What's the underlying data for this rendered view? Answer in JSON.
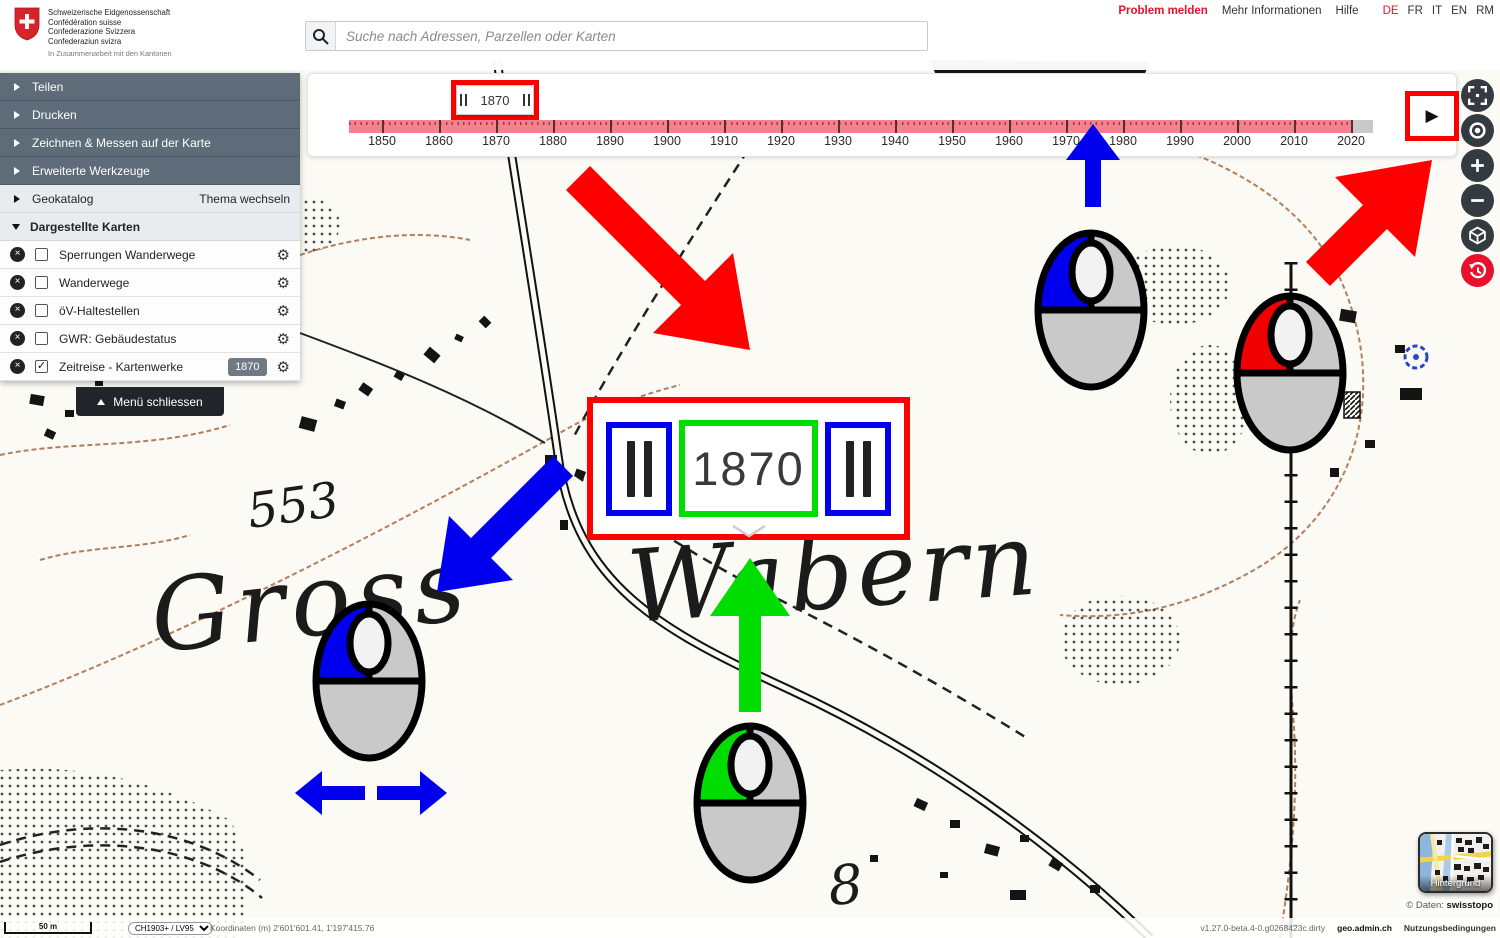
{
  "header": {
    "logo": {
      "lines": [
        "Schweizerische Eidgenossenschaft",
        "Confédération suisse",
        "Confederazione Svizzera",
        "Confederaziun svizra"
      ],
      "subline": "In Zusammenarbeit mit den Kantonen"
    },
    "search": {
      "placeholder": "Suche nach Adressen, Parzellen oder Karten"
    },
    "links": {
      "problem": "Problem melden",
      "more_info": "Mehr Informationen",
      "help": "Hilfe"
    },
    "languages": [
      {
        "label": "DE",
        "active": true
      },
      {
        "label": "FR",
        "active": false
      },
      {
        "label": "IT",
        "active": false
      },
      {
        "label": "EN",
        "active": false
      },
      {
        "label": "RM",
        "active": false
      }
    ]
  },
  "sidebar": {
    "menu_items": [
      {
        "label": "Teilen"
      },
      {
        "label": "Drucken"
      },
      {
        "label": "Zeichnen & Messen auf der Karte"
      },
      {
        "label": "Erweiterte Werkzeuge"
      }
    ],
    "geokatalog": {
      "label": "Geokatalog",
      "action": "Thema wechseln"
    },
    "layers_header": "Dargestellte Karten",
    "layers": [
      {
        "label": "Sperrungen Wanderwege",
        "checked": false
      },
      {
        "label": "Wanderwege",
        "checked": false
      },
      {
        "label": "öV-Haltestellen",
        "checked": false
      },
      {
        "label": "GWR: Gebäudestatus",
        "checked": false
      },
      {
        "label": "Zeitreise - Kartenwerke",
        "checked": true,
        "badge": "1870"
      }
    ],
    "close_menu": "Menü schliessen"
  },
  "timeline": {
    "current_year": "1870",
    "years": [
      "1850",
      "1860",
      "1870",
      "1880",
      "1890",
      "1900",
      "1910",
      "1920",
      "1930",
      "1940",
      "1950",
      "1960",
      "1970",
      "1980",
      "1990",
      "2000",
      "2010",
      "2020"
    ]
  },
  "callout": {
    "year": "1870"
  },
  "map_labels": {
    "place_large_1": "Gross",
    "place_large_2": "Wabern",
    "elevation": "553",
    "house_number": "8"
  },
  "tools": [
    {
      "name": "fullscreen"
    },
    {
      "name": "geolocate"
    },
    {
      "name": "zoom-in"
    },
    {
      "name": "zoom-out"
    },
    {
      "name": "3d-view"
    },
    {
      "name": "time-travel",
      "active": true
    }
  ],
  "tutorial": {
    "mice": [
      {
        "position": "upper-map",
        "colored_button": "left",
        "color": "blue"
      },
      {
        "position": "right-map",
        "colored_button": "left",
        "color": "red"
      },
      {
        "position": "left-map",
        "colored_button": "left",
        "color": "blue",
        "gesture": "drag-horizontal"
      },
      {
        "position": "bottom-map",
        "colored_button": "left",
        "color": "green",
        "gesture": "point-to-year"
      }
    ]
  },
  "background_selector": {
    "label": "Hintergrund"
  },
  "footer": {
    "scale": "50 m",
    "projection": "CH1903+ / LV95",
    "coordinates": "Koordinaten (m) 2'601'601.41, 1'197'415.76",
    "copyright_label": "© Daten:",
    "copyright_owner": "swisstopo",
    "version": "v1.27.0-beta.4-0.g0268423c.dirty",
    "site": "geo.admin.ch",
    "terms": "Nutzungsbedingungen"
  },
  "glyphs": {
    "close": "×",
    "check": "✓",
    "gear": "⚙",
    "play": "▶",
    "select_chevron": "▾"
  },
  "colors": {
    "annotation_red": "#ff0000",
    "annotation_blue": "#0000ee",
    "annotation_green": "#00dd00",
    "timeline_pink": "#f5808e",
    "accent_red": "#e8112d",
    "sidebar_dark": "#5d6c78",
    "tool_dark": "#333a40",
    "badge_gray": "#6f7a84"
  }
}
